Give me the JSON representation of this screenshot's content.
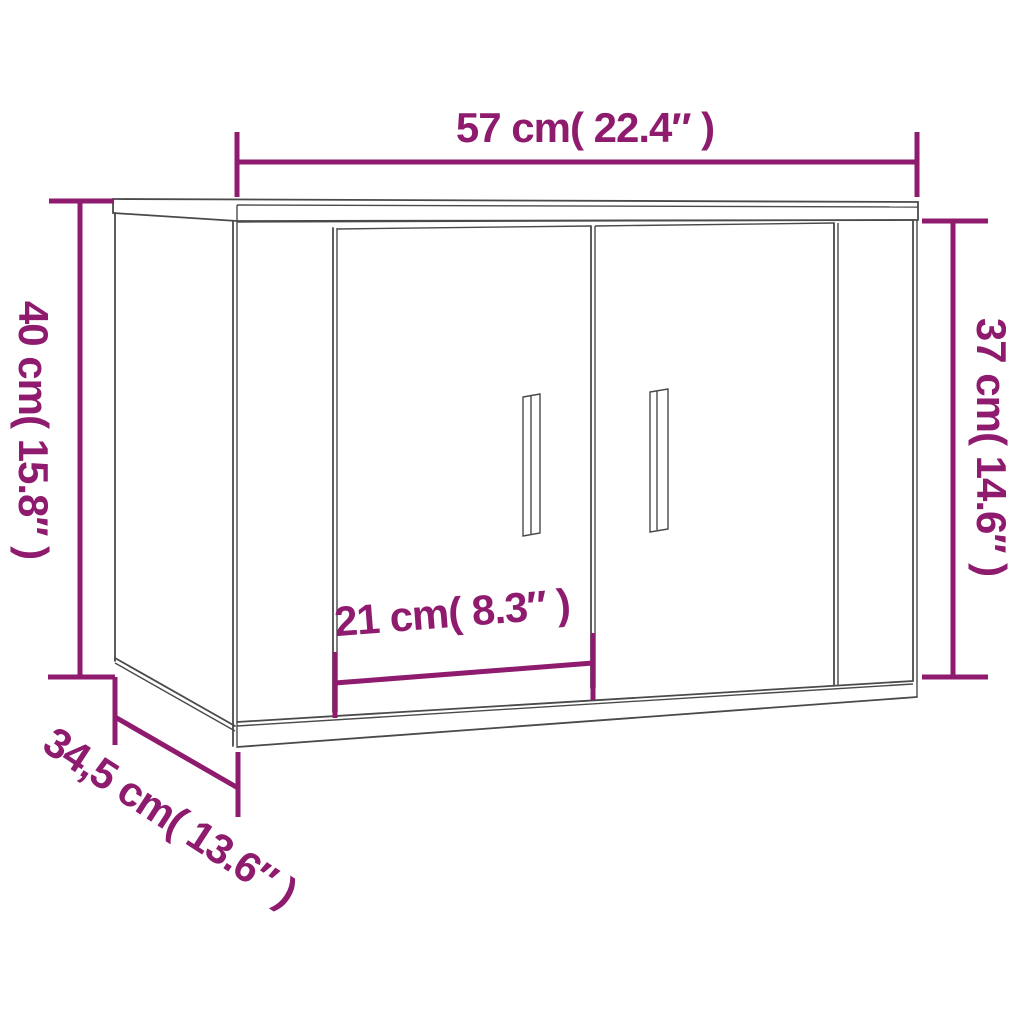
{
  "diagram": {
    "title": "cabinet-dimension-diagram",
    "dimensions": {
      "width": {
        "label": "57 cm( 22.4″ )"
      },
      "height_left": {
        "label": "40 cm( 15.8″ )"
      },
      "height_right": {
        "label": "37 cm( 14.6″ )"
      },
      "door_width": {
        "label": "21 cm( 8.3″ )"
      },
      "depth": {
        "label": "34,5 cm( 13.6″ )"
      }
    },
    "colors": {
      "accent": "#8E1B6D",
      "line": "#4A4A4A",
      "background": "#FFFFFF"
    }
  }
}
